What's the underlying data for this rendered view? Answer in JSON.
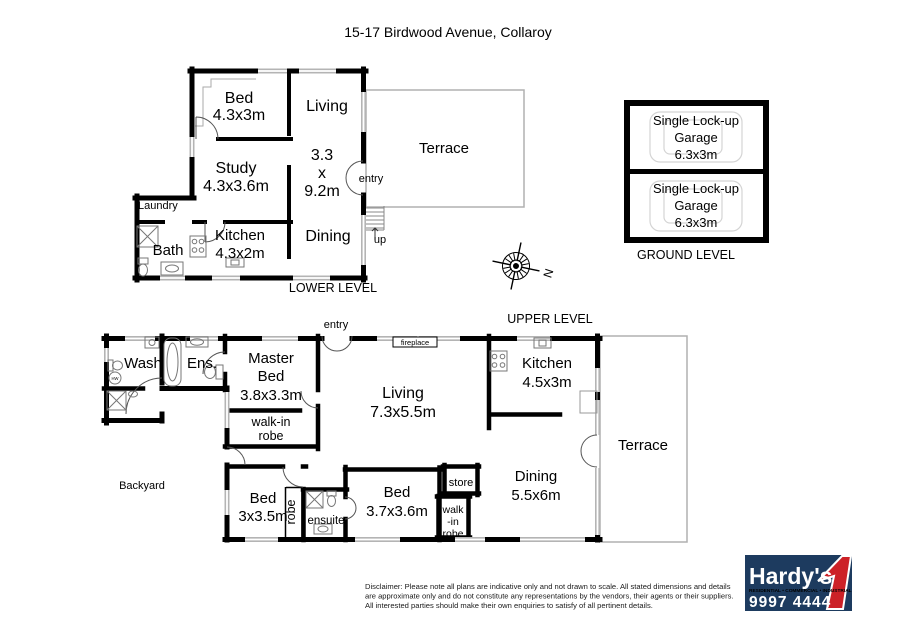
{
  "title": "15-17 Birdwood Avenue, Collaroy",
  "colors": {
    "wall": "#000000",
    "window": "#b4b4b4",
    "terrace_outline": "#b0b0b0",
    "logo_navy": "#1d3b5f",
    "logo_red": "#cc2127",
    "logo_tagline_red": "#e8534a"
  },
  "lower_level": {
    "label": "LOWER LEVEL",
    "bed_name": "Bed",
    "bed_dims": "4.3x3m",
    "living_name": "Living",
    "living_d1": "3.3",
    "living_d2": "x",
    "living_d3": "9.2m",
    "terrace": "Terrace",
    "study_name": "Study",
    "study_dims": "4.3x3.6m",
    "laundry": "Laundry",
    "bath": "Bath",
    "kitchen_name": "Kitchen",
    "kitchen_dims": "4.3x2m",
    "dining": "Dining",
    "entry": "entry",
    "up": "up"
  },
  "ground_level": {
    "label": "GROUND LEVEL",
    "garages": [
      {
        "line1": "Single Lock-up",
        "line2": "Garage",
        "dims": "6.3x3m"
      },
      {
        "line1": "Single Lock-up",
        "line2": "Garage",
        "dims": "6.3x3m"
      }
    ]
  },
  "compass": {
    "north": "N"
  },
  "upper_level": {
    "label": "UPPER LEVEL",
    "entry": "entry",
    "fireplace": "fireplace",
    "wash": "Wash",
    "hw": "HW",
    "ens": "Ens.",
    "master_l1": "Master",
    "master_l2": "Bed",
    "master_dims": "3.8x3.3m",
    "wir1_l1": "walk-in",
    "wir1_l2": "robe",
    "living_name": "Living",
    "living_dims": "7.3x5.5m",
    "kitchen_name": "Kitchen",
    "kitchen_dims": "4.5x3m",
    "terrace": "Terrace",
    "dining_name": "Dining",
    "dining_dims": "5.5x6m",
    "store": "store",
    "wir2_l1": "walk",
    "wir2_l2": "-in",
    "wir2_l3": "robe",
    "bed2_name": "Bed",
    "bed2_dims": "3x3.5m",
    "robe": "robe",
    "ensuite": "ensuite",
    "bed3_name": "Bed",
    "bed3_dims": "3.7x3.6m",
    "backyard": "Backyard"
  },
  "disclaimer": {
    "line1": "Disclaimer: Please note all plans are indicative only and not drawn to scale. All stated dimensions and details",
    "line2": "are approximate only and do not constitute any representations by the vendors, their agents or their suppliers.",
    "line3": "All interested parties should make their own enquiries to satisfy of all pertinent details."
  },
  "logo": {
    "brand": "Hardy's",
    "tagline": "RESIDENTIAL • COMMERCIAL • INDUSTRIAL",
    "phone": "9997 4444"
  }
}
